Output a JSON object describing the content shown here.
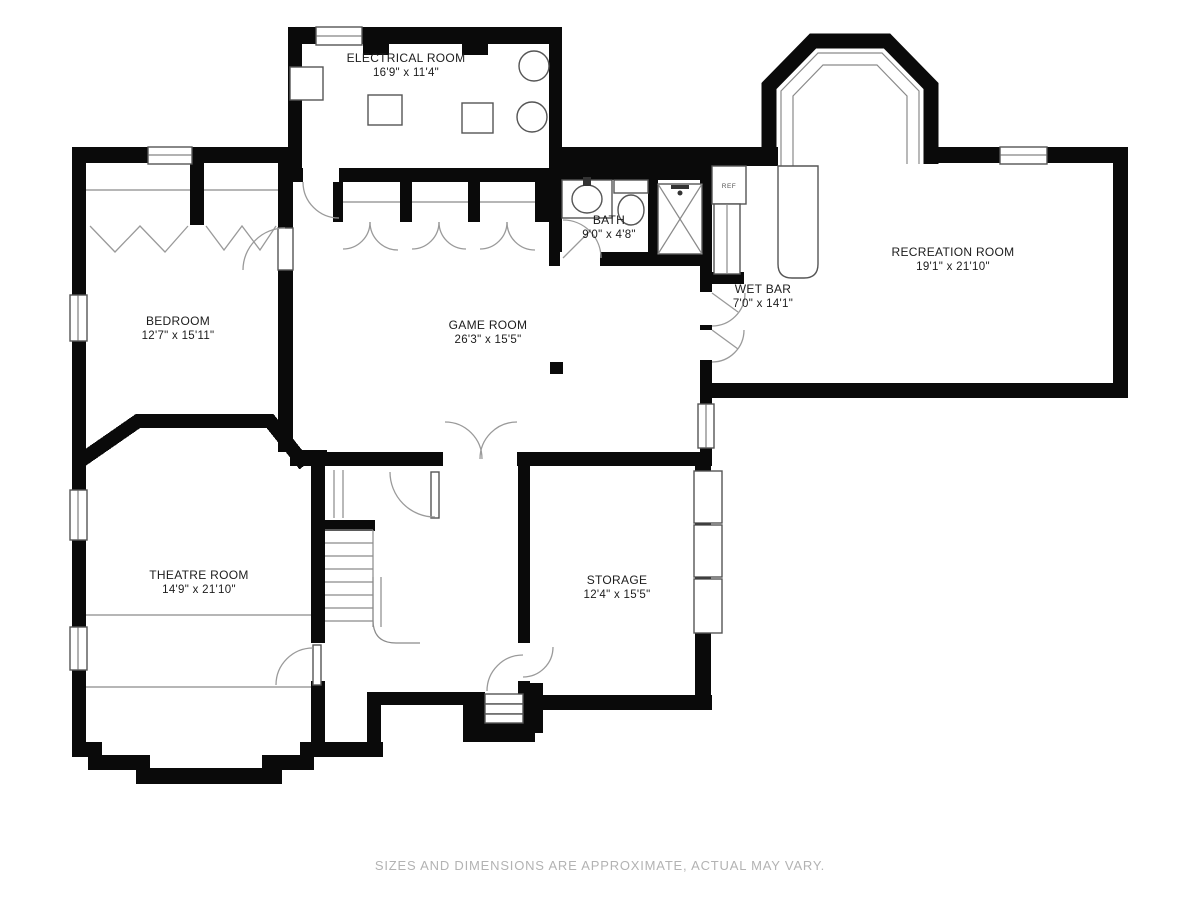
{
  "floorplan": {
    "rooms": [
      {
        "id": "electrical",
        "name": "ELECTRICAL ROOM",
        "dimensions": "16'9\" x 11'4\""
      },
      {
        "id": "bath",
        "name": "BATH",
        "dimensions": "9'0\" x 4'8\""
      },
      {
        "id": "recreation",
        "name": "RECREATION ROOM",
        "dimensions": "19'1\" x 21'10\""
      },
      {
        "id": "wetbar",
        "name": "WET BAR",
        "dimensions": "7'0\" x 14'1\""
      },
      {
        "id": "bedroom",
        "name": "BEDROOM",
        "dimensions": "12'7\" x 15'11\""
      },
      {
        "id": "game",
        "name": "GAME ROOM",
        "dimensions": "26'3\" x 15'5\""
      },
      {
        "id": "theatre",
        "name": "THEATRE ROOM",
        "dimensions": "14'9\" x 21'10\""
      },
      {
        "id": "storage",
        "name": "STORAGE",
        "dimensions": "12'4\" x 15'5\""
      }
    ],
    "fixture_labels": {
      "refrigerator": "REF"
    },
    "disclaimer": "SIZES AND DIMENSIONS ARE APPROXIMATE, ACTUAL MAY VARY.",
    "colors": {
      "wall": "#0a0a0a",
      "background": "#ffffff",
      "fixture_line": "#555555",
      "door_arc": "#9a9a9a",
      "label_text": "#1c1c1c",
      "disclaimer_text": "#b3b3b3"
    }
  }
}
